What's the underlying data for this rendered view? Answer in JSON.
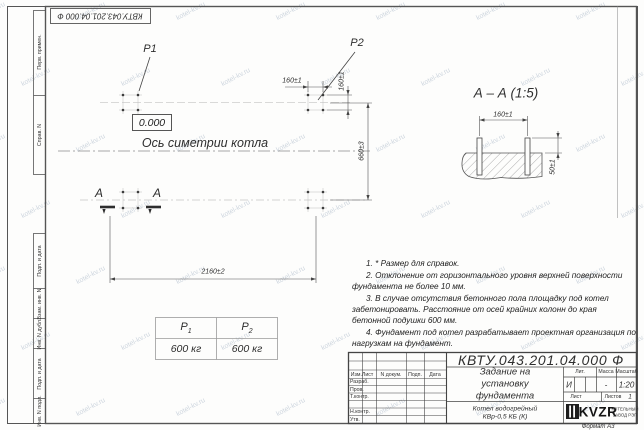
{
  "doc_number": "КВТУ.043.201.04.000 Ф",
  "watermark_text": "kotel-kv.ru",
  "frame_labels": {
    "perv_primen": "Перв. примен.",
    "sprav_n": "Справ. N",
    "podp_data_1": "Подп. и дата",
    "vzam_inv": "Взам. инв. N",
    "inv_dubl": "Инв. N дубл.",
    "podp_data_2": "Подп. и дата",
    "inv_podl": "Инв. N подл."
  },
  "plan": {
    "p1_label": "P1",
    "p2_label": "P2",
    "level_mark": "0.000",
    "axis_label": "Ось симетрии котла",
    "section_letter_left": "А",
    "section_letter_right": "А",
    "dim_bolt_spacing_x": "160±1",
    "dim_bolt_spacing_y": "160±1",
    "dim_width": "660±3",
    "dim_length": "2160±2"
  },
  "section_view": {
    "title": "А – А (1:5)",
    "dim_bolt_spacing": "160±1",
    "dim_bolt_height": "50±1"
  },
  "load_table": {
    "col1_base": "P",
    "col1_sub": "1",
    "col2_base": "P",
    "col2_sub": "2",
    "col1_value": "600 кг",
    "col2_value": "600 кг"
  },
  "notes": [
    "1. * Размер для справок.",
    "2. Отклонение от горизонтального уровня верхней поверхности фундамента не более 10 мм.",
    "3. В случае отсутствия бетонного пола площадку под котел забетонировать. Расстояние от осей крайних колонн до края бетонной подушки 600 мм.",
    "4. Фундамент под котел разрабатывает проектная организация по нагрузкам на фундамент."
  ],
  "title_block": {
    "header_cols": {
      "izm": "Изм.Лист",
      "doc": "N докум.",
      "podp": "Подп.",
      "data": "Дата"
    },
    "rows": {
      "razrab": "Разраб.",
      "prov": "Пров.",
      "tkontr": "Т.контр.",
      "nkontr": "Н.контр.",
      "utv": "Утв."
    },
    "title_lines": [
      "Задание на",
      "установку",
      "фундамента"
    ],
    "product_lines": [
      "Котел водогрейный",
      "КВр-0,5 КБ (К)"
    ],
    "lit_header": "Лит.",
    "massa_header": "Масса",
    "masshtab_header": "Масштаб",
    "lit_value": "И",
    "massa_value": "-",
    "masshtab_value": "1:20",
    "list_label": "Лист",
    "listov_label": "Листов",
    "listov_value": "1",
    "logo_text": "KVZR",
    "logo_sub": [
      "КОТЕЛЬНЫЙ",
      "ЗАВОД РЭП"
    ],
    "format_label": "Формат А3"
  }
}
